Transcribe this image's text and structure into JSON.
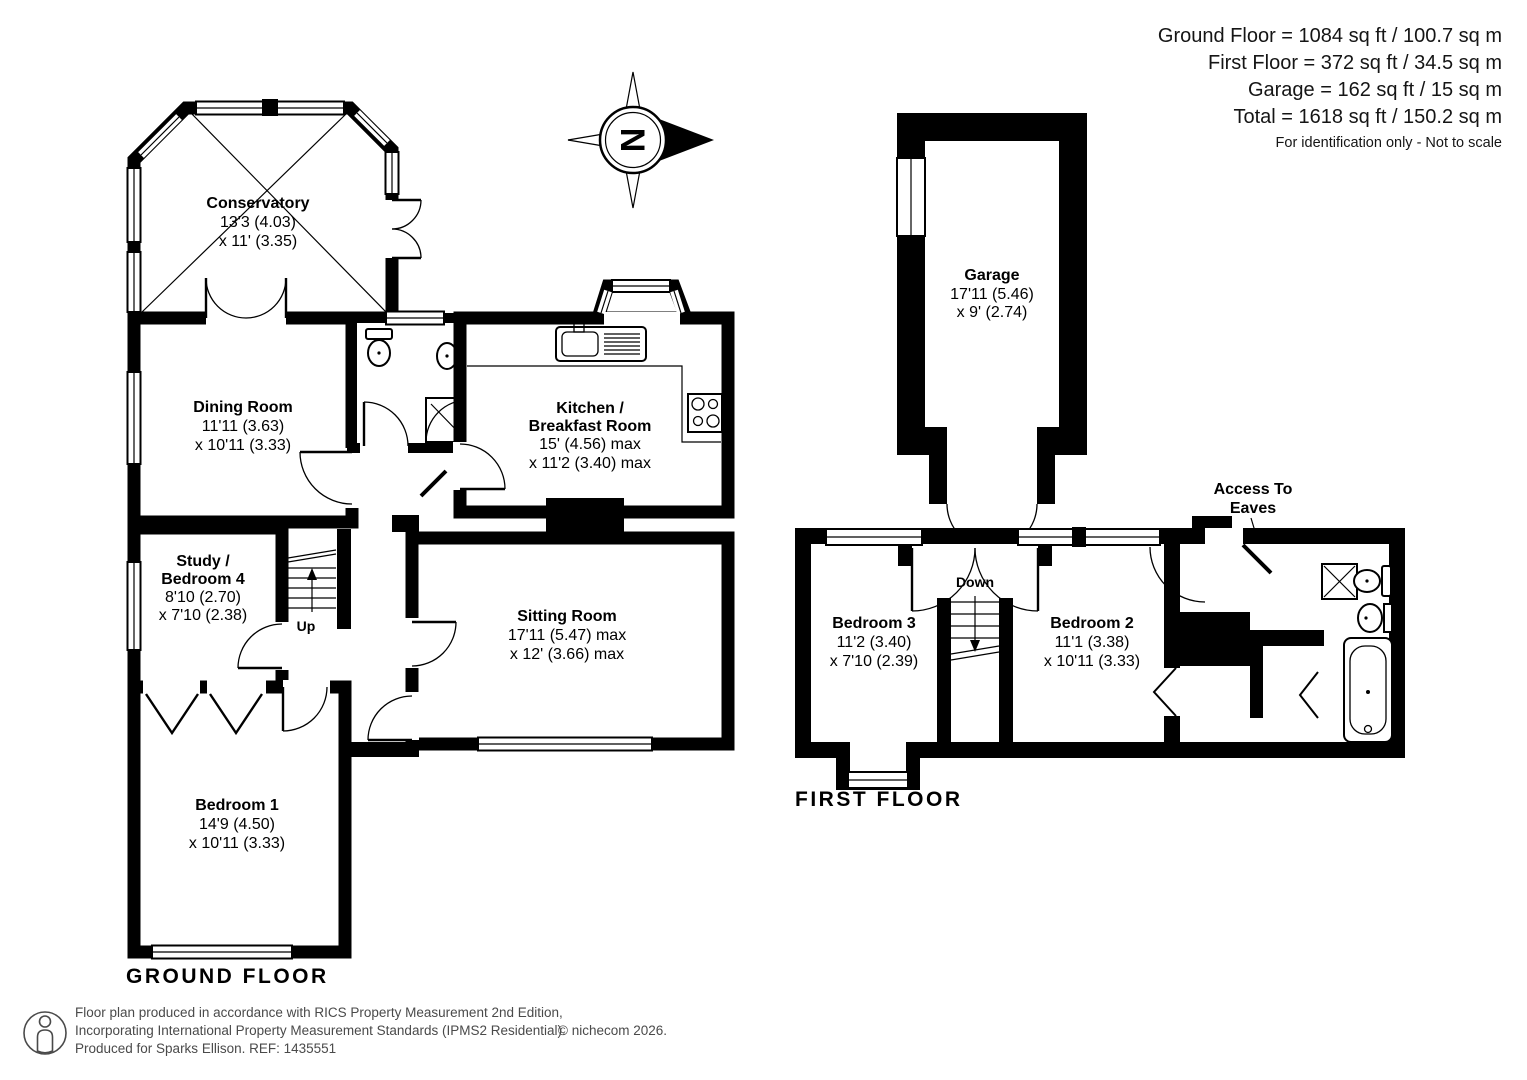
{
  "summary": {
    "ground_floor": "Ground Floor = 1084 sq ft / 100.7 sq m",
    "first_floor": "First Floor = 372 sq ft / 34.5 sq m",
    "garage": "Garage = 162 sq ft / 15 sq m",
    "total": "Total = 1618 sq ft / 150.2 sq m",
    "disclaimer": "For identification only - Not to scale"
  },
  "floor_titles": {
    "ground": "GROUND FLOOR",
    "first": "FIRST FLOOR"
  },
  "rooms": {
    "conservatory": {
      "name": "Conservatory",
      "dim1": "13'3 (4.03)",
      "dim2": "x 11' (3.35)"
    },
    "dining": {
      "name": "Dining Room",
      "dim1": "11'11 (3.63)",
      "dim2": "x 10'11 (3.33)"
    },
    "kitchen": {
      "name1": "Kitchen /",
      "name2": "Breakfast Room",
      "dim1": "15' (4.56) max",
      "dim2": "x 11'2 (3.40) max"
    },
    "sitting": {
      "name": "Sitting Room",
      "dim1": "17'11 (5.47) max",
      "dim2": "x 12' (3.66) max"
    },
    "study": {
      "name1": "Study /",
      "name2": "Bedroom 4",
      "dim1": "8'10 (2.70)",
      "dim2": "x 7'10 (2.38)"
    },
    "bedroom1": {
      "name": "Bedroom 1",
      "dim1": "14'9 (4.50)",
      "dim2": "x 10'11 (3.33)"
    },
    "garage": {
      "name": "Garage",
      "dim1": "17'11 (5.46)",
      "dim2": "x 9' (2.74)"
    },
    "bedroom3": {
      "name": "Bedroom 3",
      "dim1": "11'2 (3.40)",
      "dim2": "x 7'10 (2.39)"
    },
    "bedroom2": {
      "name": "Bedroom 2",
      "dim1": "11'1 (3.38)",
      "dim2": "x 10'11 (3.33)"
    }
  },
  "annotations": {
    "up": "Up",
    "down": "Down",
    "access_line1": "Access To",
    "access_line2": "Eaves",
    "north": "N"
  },
  "footer": {
    "line1": "Floor plan produced in accordance with RICS Property Measurement 2nd Edition,",
    "line2": "Incorporating International Property Measurement Standards (IPMS2 Residential).",
    "line3": "Produced for Sparks Ellison.   REF: 1435551",
    "copyright": "© nichecom 2026."
  },
  "colors": {
    "wall": "#000000",
    "background": "#ffffff",
    "footer_text": "#4a4a4a"
  }
}
